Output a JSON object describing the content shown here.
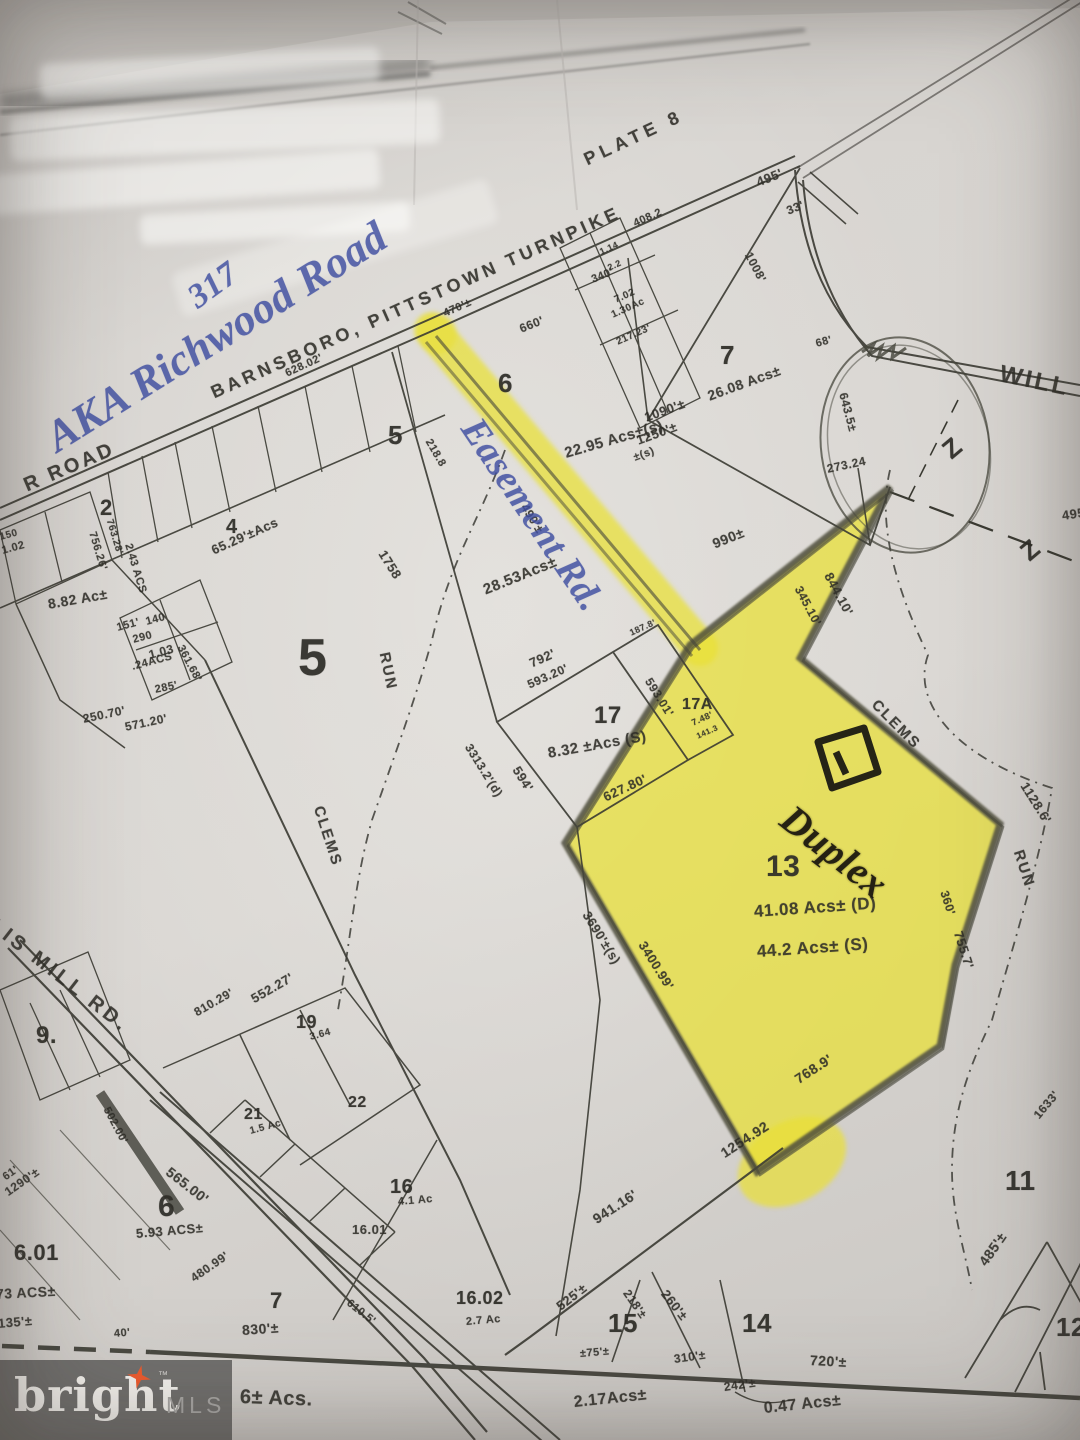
{
  "meta": {
    "description": "Photographed tax plat map sheet, Plate 8, with parcel 13 highlighted in yellow and handwritten notes"
  },
  "colors": {
    "highlighter": "#e9e034",
    "ink_blue": "#3e4da0",
    "line": "#3a3a32",
    "paper": "#d8d5d1",
    "logo_bg": "#6a6967",
    "logo_star": "#ee5b2e"
  },
  "logo": {
    "brand": "bright",
    "tm": "™",
    "suffix": "MLS"
  },
  "labels": [
    {
      "t": "PLATE 8",
      "x": 585,
      "y": 150,
      "r": -25,
      "s": 18,
      "ls": 5,
      "n": "plate-number"
    },
    {
      "t": "BARNSBORO, PITTSTOWN TURNPIKE",
      "x": 212,
      "y": 383,
      "r": -24,
      "s": 18,
      "ls": 4,
      "n": "road-label-turnpike"
    },
    {
      "t": "R ROAD",
      "x": 25,
      "y": 475,
      "r": -23,
      "s": 20,
      "ls": 3,
      "n": "road-label-r-road"
    },
    {
      "t": "LIS MILL RD.",
      "x": -8,
      "y": 912,
      "r": 38,
      "s": 20,
      "ls": 4,
      "n": "road-label-ellis-mill"
    },
    {
      "t": "WILL",
      "x": 1000,
      "y": 360,
      "r": 12,
      "s": 24,
      "ls": 3,
      "n": "road-label-will"
    },
    {
      "t": "565.00'",
      "x": 168,
      "y": 1162,
      "r": 38,
      "s": 14
    },
    {
      "t": "720'±",
      "x": 810,
      "y": 1352,
      "r": 3,
      "s": 14
    },
    {
      "t": "5",
      "x": 298,
      "y": 628,
      "r": 0,
      "s": 52,
      "c": "print-b",
      "n": "parcel-5-number"
    },
    {
      "t": "5",
      "x": 388,
      "y": 420,
      "r": 0,
      "s": 26,
      "c": "print-b"
    },
    {
      "t": "6",
      "x": 498,
      "y": 368,
      "r": 0,
      "s": 26,
      "c": "print-b",
      "n": "parcel-6-number"
    },
    {
      "t": "7",
      "x": 720,
      "y": 340,
      "r": 0,
      "s": 26,
      "c": "print-b",
      "n": "parcel-7-number"
    },
    {
      "t": "2",
      "x": 100,
      "y": 495,
      "r": 0,
      "s": 22,
      "c": "print-b"
    },
    {
      "t": "4",
      "x": 226,
      "y": 516,
      "r": 0,
      "s": 20,
      "c": "print-b"
    },
    {
      "t": "17",
      "x": 594,
      "y": 702,
      "r": 0,
      "s": 24,
      "c": "print-b",
      "n": "parcel-17-number"
    },
    {
      "t": "17A",
      "x": 682,
      "y": 696,
      "r": 0,
      "s": 16,
      "c": "print-b"
    },
    {
      "t": "13",
      "x": 766,
      "y": 850,
      "r": 0,
      "s": 30,
      "c": "print-b",
      "n": "parcel-13-number"
    },
    {
      "t": "11",
      "x": 1005,
      "y": 1165,
      "r": 0,
      "s": 28,
      "c": "print-b"
    },
    {
      "t": "15",
      "x": 608,
      "y": 1308,
      "r": 0,
      "s": 26,
      "c": "print-b"
    },
    {
      "t": "14",
      "x": 742,
      "y": 1308,
      "r": 0,
      "s": 26,
      "c": "print-b"
    },
    {
      "t": "12",
      "x": 1056,
      "y": 1312,
      "r": 0,
      "s": 26,
      "c": "print-b"
    },
    {
      "t": "9.",
      "x": 36,
      "y": 1022,
      "r": 0,
      "s": 24,
      "c": "print-b"
    },
    {
      "t": "19",
      "x": 296,
      "y": 1012,
      "r": 0,
      "s": 18,
      "c": "print-b"
    },
    {
      "t": "21",
      "x": 244,
      "y": 1106,
      "r": 0,
      "s": 16,
      "c": "print-b"
    },
    {
      "t": "22",
      "x": 348,
      "y": 1094,
      "r": 0,
      "s": 16,
      "c": "print-b"
    },
    {
      "t": "16",
      "x": 390,
      "y": 1176,
      "r": 0,
      "s": 20,
      "c": "print-b"
    },
    {
      "t": "6",
      "x": 158,
      "y": 1190,
      "r": 0,
      "s": 30,
      "c": "print-b"
    },
    {
      "t": "7",
      "x": 270,
      "y": 1288,
      "r": 0,
      "s": 22,
      "c": "print-b"
    },
    {
      "t": "6.01",
      "x": 14,
      "y": 1240,
      "r": 0,
      "s": 22,
      "c": "print-b"
    },
    {
      "t": "16.01",
      "x": 352,
      "y": 1222,
      "r": 0,
      "s": 13
    },
    {
      "t": "16.02",
      "x": 456,
      "y": 1288,
      "r": 0,
      "s": 18,
      "c": "print-b"
    },
    {
      "t": "22.95 Acs±(s)",
      "x": 565,
      "y": 445,
      "r": -16,
      "s": 15
    },
    {
      "t": "26.08 Acs±",
      "x": 708,
      "y": 388,
      "r": -20,
      "s": 14
    },
    {
      "t": "1090'±",
      "x": 645,
      "y": 410,
      "r": -20,
      "s": 13
    },
    {
      "t": "1250'±",
      "x": 637,
      "y": 433,
      "r": -20,
      "s": 13
    },
    {
      "t": "±(s)",
      "x": 634,
      "y": 452,
      "r": -20,
      "s": 11
    },
    {
      "t": "28.53Acs±",
      "x": 484,
      "y": 582,
      "r": -22,
      "s": 15
    },
    {
      "t": "8.32 ±Acs (S)",
      "x": 548,
      "y": 745,
      "r": -10,
      "s": 15
    },
    {
      "t": "792'",
      "x": 530,
      "y": 656,
      "r": -24,
      "s": 13
    },
    {
      "t": "593.20'",
      "x": 528,
      "y": 678,
      "r": -24,
      "s": 12
    },
    {
      "t": "593.01'",
      "x": 648,
      "y": 672,
      "r": 58,
      "s": 12
    },
    {
      "t": "594'",
      "x": 516,
      "y": 760,
      "r": 58,
      "s": 13
    },
    {
      "t": "3313.2'(d)",
      "x": 468,
      "y": 738,
      "r": 58,
      "s": 12
    },
    {
      "t": "187.8'",
      "x": 630,
      "y": 628,
      "r": -24,
      "s": 9
    },
    {
      "t": "7.48'",
      "x": 692,
      "y": 718,
      "r": -24,
      "s": 9
    },
    {
      "t": "141.3",
      "x": 697,
      "y": 732,
      "r": -24,
      "s": 8
    },
    {
      "t": "627.80'",
      "x": 604,
      "y": 790,
      "r": -25,
      "s": 13
    },
    {
      "t": "3690'±(s)",
      "x": 586,
      "y": 905,
      "r": 58,
      "s": 13
    },
    {
      "t": "3400.99'",
      "x": 642,
      "y": 935,
      "r": 58,
      "s": 13
    },
    {
      "t": "41.08 Acs± (D)",
      "x": 754,
      "y": 902,
      "r": -4,
      "s": 17,
      "n": "parcel-13-acreage-d"
    },
    {
      "t": "44.2 Acs± (S)",
      "x": 757,
      "y": 942,
      "r": -4,
      "s": 17,
      "n": "parcel-13-acreage-s"
    },
    {
      "t": "990±",
      "x": 713,
      "y": 536,
      "r": -22,
      "s": 14
    },
    {
      "t": "844.10'",
      "x": 828,
      "y": 566,
      "r": 62,
      "s": 13
    },
    {
      "t": "345.10'",
      "x": 798,
      "y": 580,
      "r": 62,
      "s": 12
    },
    {
      "t": "273.24",
      "x": 827,
      "y": 462,
      "r": -12,
      "s": 12
    },
    {
      "t": "643.5±",
      "x": 843,
      "y": 386,
      "r": 75,
      "s": 12
    },
    {
      "t": "68'",
      "x": 816,
      "y": 338,
      "r": -15,
      "s": 11
    },
    {
      "t": "1008'",
      "x": 748,
      "y": 246,
      "r": 62,
      "s": 12
    },
    {
      "t": "495'",
      "x": 757,
      "y": 175,
      "r": -22,
      "s": 13
    },
    {
      "t": "33'",
      "x": 787,
      "y": 204,
      "r": -22,
      "s": 12
    },
    {
      "t": "495'",
      "x": 1062,
      "y": 508,
      "r": -8,
      "s": 13
    },
    {
      "t": "408.2",
      "x": 634,
      "y": 218,
      "r": -24,
      "s": 11
    },
    {
      "t": "628.02'",
      "x": 286,
      "y": 368,
      "r": -25,
      "s": 11
    },
    {
      "t": "470'±",
      "x": 444,
      "y": 308,
      "r": -24,
      "s": 11
    },
    {
      "t": "660'",
      "x": 520,
      "y": 322,
      "r": -22,
      "s": 12
    },
    {
      "t": "340'",
      "x": 592,
      "y": 274,
      "r": -22,
      "s": 11
    },
    {
      "t": "218.8",
      "x": 428,
      "y": 434,
      "r": 60,
      "s": 11
    },
    {
      "t": "490'±",
      "x": 524,
      "y": 498,
      "r": 58,
      "s": 12
    },
    {
      "t": "1758",
      "x": 382,
      "y": 544,
      "r": 58,
      "s": 13
    },
    {
      "t": "RUN",
      "x": 384,
      "y": 644,
      "r": 78,
      "s": 15,
      "ls": 2
    },
    {
      "t": "CLEMS",
      "x": 318,
      "y": 798,
      "r": 72,
      "s": 15,
      "ls": 2
    },
    {
      "t": "CLEMS",
      "x": 874,
      "y": 694,
      "r": 45,
      "s": 15,
      "ls": 2
    },
    {
      "t": "RUN",
      "x": 1018,
      "y": 842,
      "r": 72,
      "s": 15,
      "ls": 2
    },
    {
      "t": "1128.6'",
      "x": 1024,
      "y": 776,
      "r": 58,
      "s": 13
    },
    {
      "t": "755.7'",
      "x": 958,
      "y": 924,
      "r": 72,
      "s": 13
    },
    {
      "t": "360'",
      "x": 944,
      "y": 884,
      "r": 72,
      "s": 12
    },
    {
      "t": "768.9'",
      "x": 796,
      "y": 1072,
      "r": -33,
      "s": 14
    },
    {
      "t": "1254.92",
      "x": 722,
      "y": 1146,
      "r": -33,
      "s": 14
    },
    {
      "t": "941.16'",
      "x": 594,
      "y": 1212,
      "r": -33,
      "s": 14
    },
    {
      "t": "485'±",
      "x": 982,
      "y": 1256,
      "r": -55,
      "s": 14
    },
    {
      "t": "1633'",
      "x": 1036,
      "y": 1110,
      "r": -50,
      "s": 12
    },
    {
      "t": "525'±",
      "x": 558,
      "y": 1300,
      "r": -38,
      "s": 13
    },
    {
      "t": "218'±",
      "x": 626,
      "y": 1284,
      "r": 55,
      "s": 12
    },
    {
      "t": "260'±",
      "x": 664,
      "y": 1284,
      "r": 52,
      "s": 13
    },
    {
      "t": "310'±",
      "x": 674,
      "y": 1352,
      "r": -8,
      "s": 12
    },
    {
      "t": "±75'±",
      "x": 580,
      "y": 1348,
      "r": -5,
      "s": 11
    },
    {
      "t": "242'±",
      "x": 724,
      "y": 1380,
      "r": -8,
      "s": 12
    },
    {
      "t": "2.17Acs±",
      "x": 574,
      "y": 1394,
      "r": -6,
      "s": 16
    },
    {
      "t": "0.47 Acs±",
      "x": 764,
      "y": 1400,
      "r": -6,
      "s": 16
    },
    {
      "t": "830'±",
      "x": 242,
      "y": 1322,
      "r": -4,
      "s": 14
    },
    {
      "t": "40'",
      "x": 114,
      "y": 1328,
      "r": -5,
      "s": 11
    },
    {
      "t": "135'±",
      "x": -2,
      "y": 1316,
      "r": -5,
      "s": 13
    },
    {
      "t": "73 ACS±",
      "x": -4,
      "y": 1286,
      "r": -3,
      "s": 14
    },
    {
      "t": "1290'±",
      "x": 6,
      "y": 1186,
      "r": -35,
      "s": 12
    },
    {
      "t": "61'",
      "x": 4,
      "y": 1172,
      "r": -35,
      "s": 11
    },
    {
      "t": "5.93 ACS±",
      "x": 136,
      "y": 1226,
      "r": -5,
      "s": 13
    },
    {
      "t": "480.99'",
      "x": 192,
      "y": 1272,
      "r": -35,
      "s": 12
    },
    {
      "t": "502.00'",
      "x": 106,
      "y": 1102,
      "r": 62,
      "s": 11
    },
    {
      "t": "552.27'",
      "x": 252,
      "y": 992,
      "r": -30,
      "s": 13
    },
    {
      "t": "810.29'",
      "x": 195,
      "y": 1006,
      "r": -30,
      "s": 12
    },
    {
      "t": "610.5'",
      "x": 348,
      "y": 1296,
      "r": 38,
      "s": 11
    },
    {
      "t": "250.70'",
      "x": 83,
      "y": 712,
      "r": -12,
      "s": 12
    },
    {
      "t": "571.20'",
      "x": 125,
      "y": 720,
      "r": -12,
      "s": 12
    },
    {
      "t": "285'",
      "x": 155,
      "y": 684,
      "r": -12,
      "s": 11
    },
    {
      "t": "361.68'",
      "x": 180,
      "y": 640,
      "r": 62,
      "s": 11
    },
    {
      "t": "151'",
      "x": 117,
      "y": 622,
      "r": -15,
      "s": 11
    },
    {
      "t": "140",
      "x": 146,
      "y": 616,
      "r": -15,
      "s": 11
    },
    {
      "t": "290",
      "x": 133,
      "y": 634,
      "r": -15,
      "s": 11
    },
    {
      "t": "1.03",
      "x": 149,
      "y": 648,
      "r": -15,
      "s": 12
    },
    {
      "t": ".24ACS",
      "x": 132,
      "y": 661,
      "r": -15,
      "s": 11
    },
    {
      "t": "2.43 ACS",
      "x": 128,
      "y": 538,
      "r": 73,
      "s": 11
    },
    {
      "t": "756.26'",
      "x": 92,
      "y": 526,
      "r": 73,
      "s": 11
    },
    {
      "t": "763.28'",
      "x": 109,
      "y": 514,
      "r": 73,
      "s": 10
    },
    {
      "t": "65.29'±Acs",
      "x": 212,
      "y": 543,
      "r": -24,
      "s": 13
    },
    {
      "t": "8.82 Ac±",
      "x": 48,
      "y": 596,
      "r": -10,
      "s": 14
    },
    {
      "t": "150",
      "x": 0,
      "y": 532,
      "r": -15,
      "s": 10
    },
    {
      "t": "1.02",
      "x": 2,
      "y": 545,
      "r": -15,
      "s": 11
    },
    {
      "t": "1.14",
      "x": 600,
      "y": 247,
      "r": -24,
      "s": 9
    },
    {
      "t": "2.2",
      "x": 608,
      "y": 263,
      "r": -24,
      "s": 9
    },
    {
      "t": "7.02",
      "x": 615,
      "y": 295,
      "r": -24,
      "s": 10
    },
    {
      "t": "1.30Ac",
      "x": 612,
      "y": 310,
      "r": -24,
      "s": 10
    },
    {
      "t": "217.23'",
      "x": 617,
      "y": 337,
      "r": -24,
      "s": 10
    },
    {
      "t": "6± Acs.",
      "x": 240,
      "y": 1386,
      "r": 2,
      "s": 20,
      "n": "acreage-partial"
    },
    {
      "t": "4.1 Ac",
      "x": 398,
      "y": 1196,
      "r": -5,
      "s": 11
    },
    {
      "t": "2.7 Ac",
      "x": 466,
      "y": 1316,
      "r": -5,
      "s": 11
    },
    {
      "t": "3.64",
      "x": 310,
      "y": 1032,
      "r": -15,
      "s": 10
    },
    {
      "t": "1.5 Ac",
      "x": 250,
      "y": 1126,
      "r": -15,
      "s": 10
    },
    {
      "t": "Z",
      "x": 946,
      "y": 438,
      "r": -40,
      "s": 26,
      "c": "print-b",
      "n": "match-line-z"
    },
    {
      "t": "Z",
      "x": 1024,
      "y": 540,
      "r": -40,
      "s": 26,
      "c": "print-b",
      "n": "match-line-z"
    },
    {
      "t": "317",
      "x": 192,
      "y": 282,
      "r": -36,
      "s": 34,
      "c": "ink",
      "n": "handwritten-street-number"
    },
    {
      "t": "AKA Richwood Road",
      "x": 50,
      "y": 415,
      "r": -32,
      "s": 44,
      "c": "ink",
      "n": "handwritten-road-alias"
    },
    {
      "t": "Easement Rd.",
      "x": 470,
      "y": 400,
      "r": 56,
      "s": 38,
      "c": "ink",
      "n": "handwritten-easement-road"
    },
    {
      "t": "Duplex",
      "x": 786,
      "y": 790,
      "r": 38,
      "s": 40,
      "c": "marker",
      "n": "handwritten-duplex"
    }
  ]
}
